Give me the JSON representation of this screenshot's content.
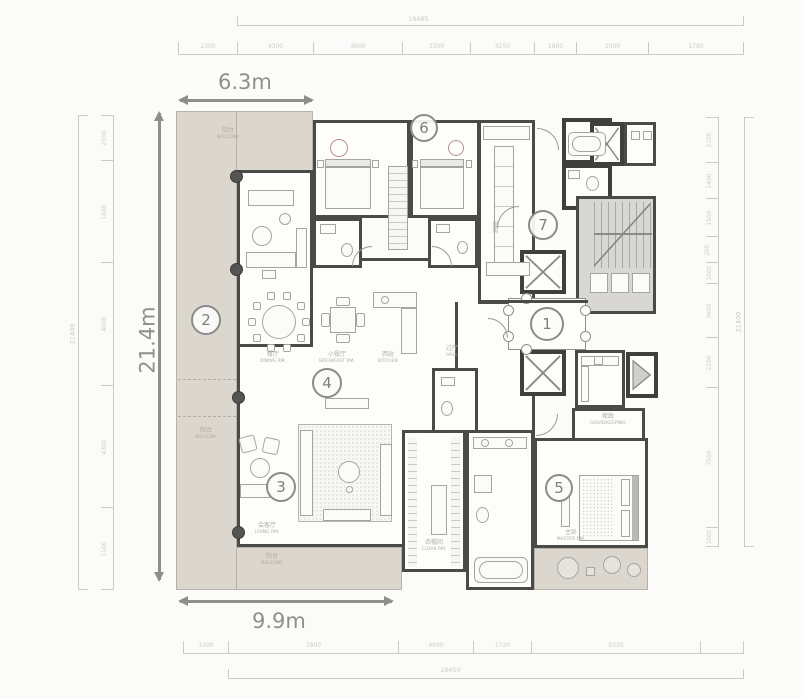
{
  "measurements": {
    "top_width": "6.3m",
    "left_height": "21.4m",
    "bottom_width": "9.9m"
  },
  "markers": [
    "1",
    "2",
    "3",
    "4",
    "5",
    "6",
    "7"
  ],
  "dims": {
    "top_total": "19465",
    "top_segments": [
      "2300",
      "4300",
      "3600",
      "3300",
      "3250",
      "1900",
      "2000",
      "1780"
    ],
    "bottom_segments": [
      "1000",
      "7800",
      "4600",
      "1720",
      "5330"
    ],
    "bottom_total": "18450",
    "left_segments": [
      "2500",
      "1800",
      "4000",
      "4300",
      "1100"
    ],
    "left_total": "21400",
    "right_segments": [
      "2100",
      "1400",
      "1500",
      "200",
      "1000",
      "3600",
      "2200",
      "7500",
      "1000"
    ],
    "right_total": "21400"
  },
  "room_labels": {
    "balcony_top": {
      "zh": "阳台",
      "en": "BALCONY"
    },
    "balcony_left": {
      "zh": "阳台",
      "en": "BALCONY"
    },
    "balcony_bottom": {
      "zh": "阳台",
      "en": "BALCONY"
    },
    "dining": {
      "zh": "餐厅",
      "en": "DINING RM."
    },
    "breakfast": {
      "zh": "小餐厅",
      "en": "BREAKFAST RM."
    },
    "west_kitchen": {
      "zh": "西厨",
      "en": "KITCHEN"
    },
    "living": {
      "zh": "会客厅",
      "en": "LIVING RM."
    },
    "kitchen": {
      "zh": "厨房",
      "en": "KITCHEN"
    },
    "hall": {
      "zh": "过厅",
      "en": "HALL"
    },
    "master": {
      "zh": "主卧",
      "en": "MASTER RM."
    },
    "cloak": {
      "zh": "衣帽间",
      "en": "CLOAK RM."
    },
    "housekeeping": {
      "zh": "家政",
      "en": "HOUSEKEEPING"
    }
  }
}
